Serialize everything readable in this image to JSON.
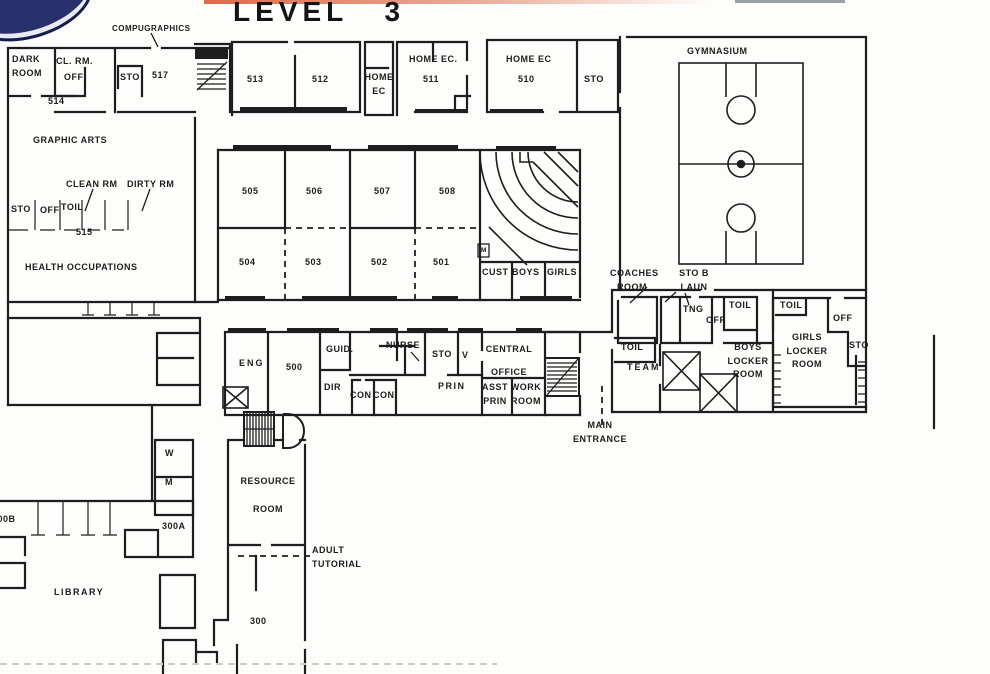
{
  "title": "LEVEL 3",
  "colors": {
    "ink": "#1e1e1e",
    "paper": "#fdfdfb",
    "band_red": "#dd6a47",
    "band_grey": "#9aa0a4",
    "logo_navy": "#27306b"
  },
  "icons": {
    "stairs": "stairs-icon",
    "basketball_court": "basketball-court-icon",
    "equipment_mat": "x-mat-icon",
    "lecture_seating": "tiered-seating-arcs"
  },
  "labels": {
    "compugraphics": "COMPUGRAPHICS",
    "dark_room": "DARK\nROOM",
    "cl_rm": "CL. RM.",
    "off_a": "OFF",
    "sto_a": "STO",
    "r517": "517",
    "r514": "514",
    "r513": "513",
    "r512": "512",
    "home_ec_a": "HOME\nEC",
    "home_ec_b": "HOME EC.",
    "r511": "511",
    "home_ec_c": "HOME EC",
    "r510": "510",
    "sto_b": "STO",
    "gymnasium": "GYMNASIUM",
    "graphic_arts": "GRAPHIC ARTS",
    "clean_rm": "CLEAN RM",
    "dirty_rm": "DIRTY RM",
    "sto_c": "STO",
    "off_b": "OFF",
    "toil_a": "TOIL",
    "r515": "515",
    "health_occupations": "HEALTH  OCCUPATIONS",
    "r505": "505",
    "r506": "506",
    "r507": "507",
    "r508": "508",
    "r504": "504",
    "r503": "503",
    "r502": "502",
    "r501": "501",
    "cust": "CUST",
    "boys": "BOYS",
    "girls": "GIRLS",
    "m_small": "M",
    "coaches_room": "COACHES\nROOM",
    "sto_laun": "STO B\nLAUN",
    "tng": "TNG",
    "off_c": "OFF",
    "toil_b": "TOIL",
    "toil_c": "TOIL",
    "team": "TEAM",
    "boys_locker": "BOYS\nLOCKER\nROOM",
    "toil_d": "TOIL",
    "off_d": "OFF",
    "girls_locker": "GIRLS\nLOCKER\nROOM",
    "sto_d": "STO",
    "eng": "ENG",
    "r500": "500",
    "guid": "GUID.",
    "dir": "DIR",
    "con_a": "CON",
    "con_b": "CON",
    "nurse": "NURSE",
    "sto_e": "STO",
    "vault": "V",
    "central_office": "CENTRAL\nOFFICE",
    "prin": "PRIN",
    "asst_prin": "ASST\nPRIN",
    "work_room": "WORK\nROOM",
    "main_entrance": "MAIN\nENTRANCE",
    "w": "W",
    "m": "M",
    "resource_room": "RESOURCE\nROOM",
    "adult_tutorial": "ADULT\nTUTORIAL",
    "r300a": "300A",
    "r300b": "300B",
    "library": "LIBRARY",
    "r300": "300"
  }
}
